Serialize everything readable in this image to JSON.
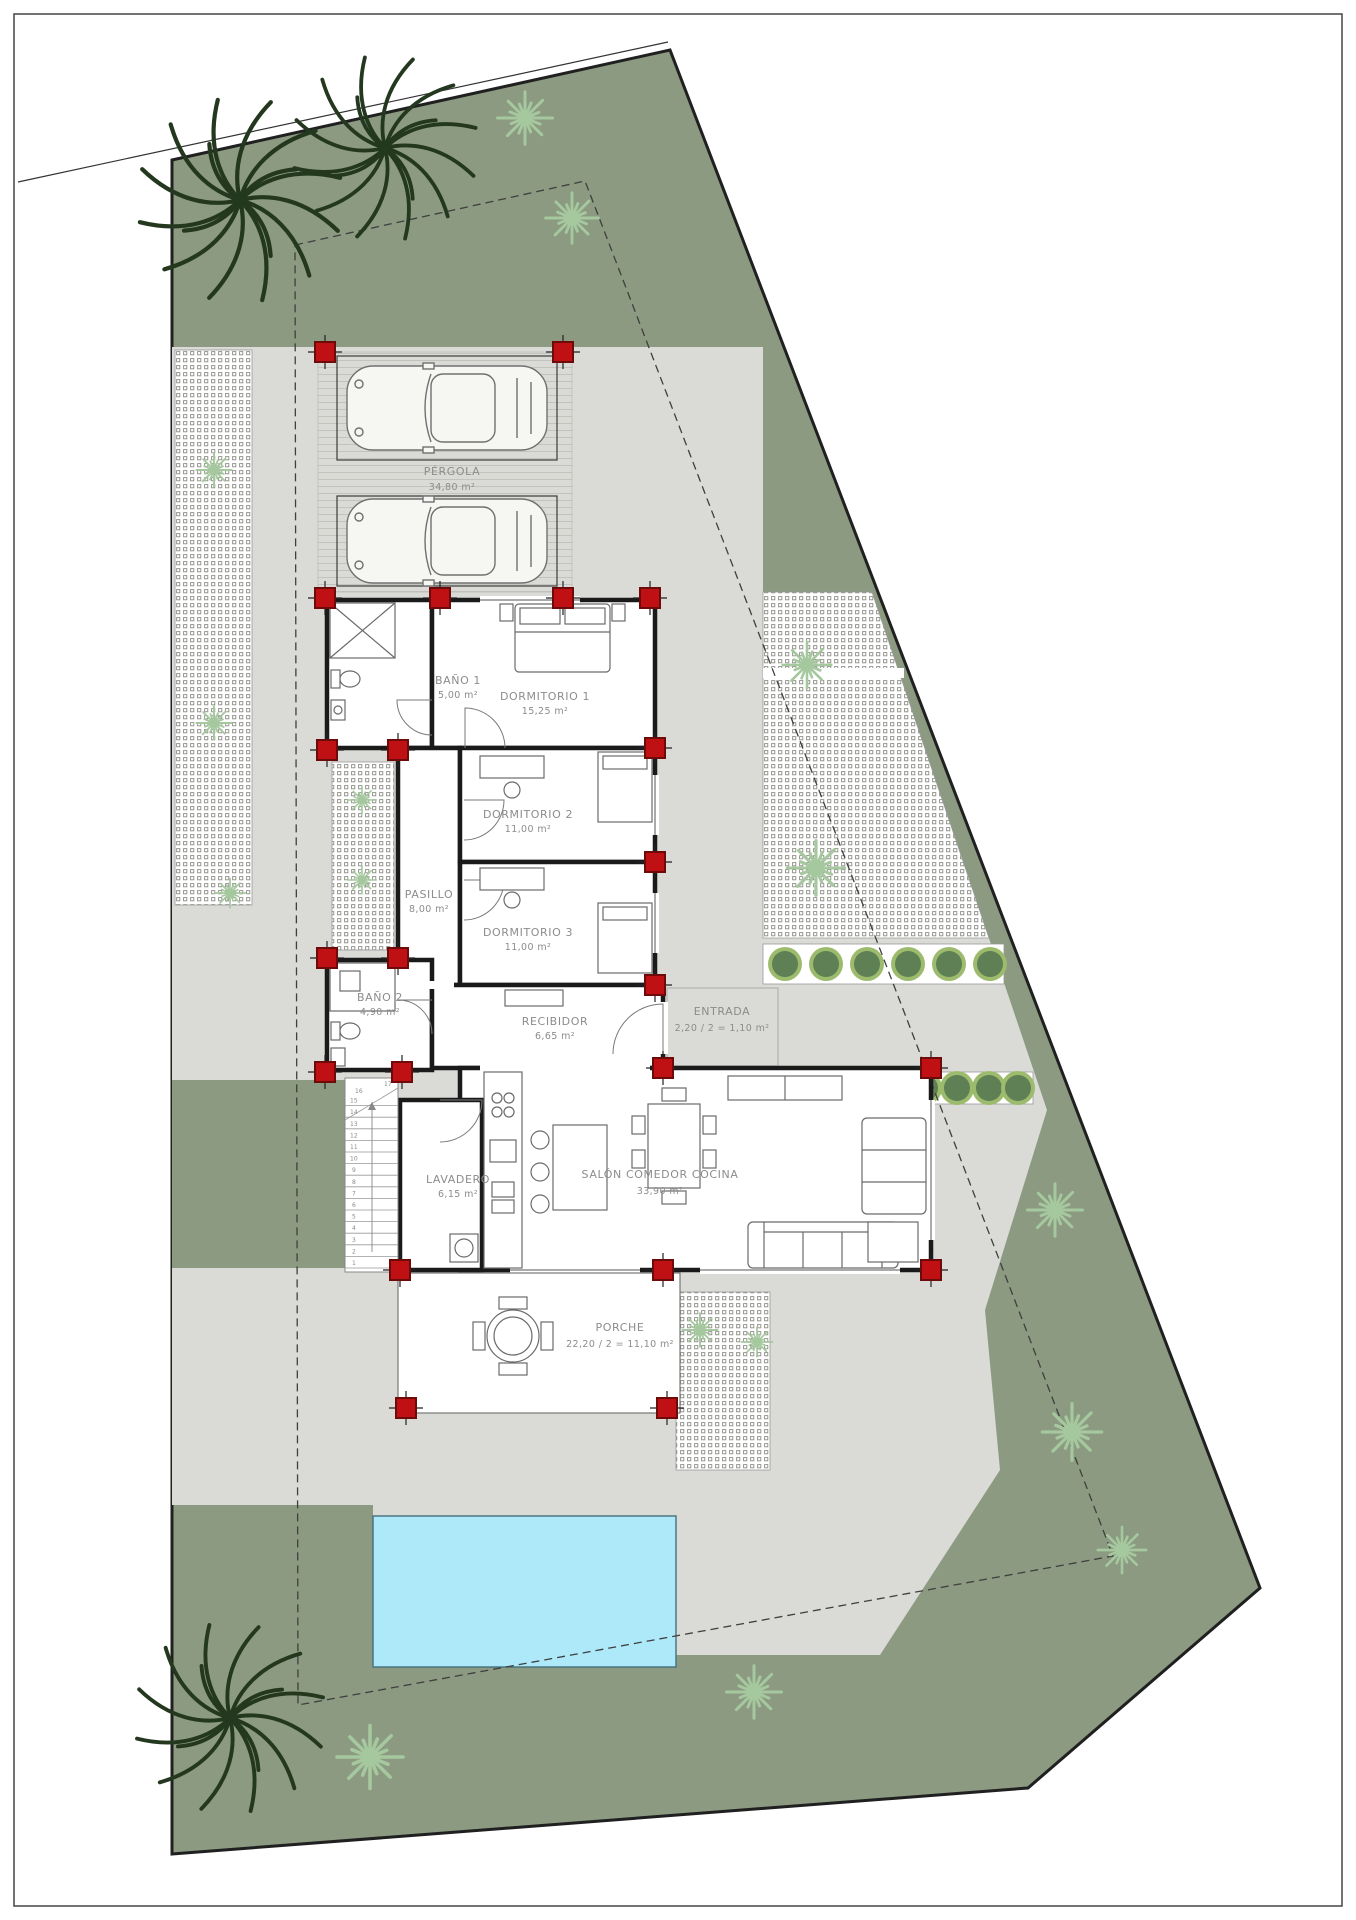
{
  "rooms": {
    "pergola": {
      "name": "PÉRGOLA",
      "area": "34,80 m²"
    },
    "dormitorio1": {
      "name": "DORMITORIO 1",
      "area": "15,25 m²"
    },
    "bano1": {
      "name": "BAÑO 1",
      "area": "5,00 m²"
    },
    "dormitorio2": {
      "name": "DORMITORIO 2",
      "area": "11,00 m²"
    },
    "pasillo": {
      "name": "PASILLO",
      "area": "8,00 m²"
    },
    "dormitorio3": {
      "name": "DORMITORIO 3",
      "area": "11,00 m²"
    },
    "bano2": {
      "name": "BAÑO 2",
      "area": "4,90 m²"
    },
    "recibidor": {
      "name": "RECIBIDOR",
      "area": "6,65 m²"
    },
    "entrada": {
      "name": "ENTRADA",
      "area": "2,20 / 2 = 1,10 m²"
    },
    "lavadero": {
      "name": "LAVADERO",
      "area": "6,15 m²"
    },
    "salon": {
      "name": "SALÓN COMEDOR COCINA",
      "area": "33,90 m²"
    },
    "porche": {
      "name": "PORCHE",
      "area": "22,20 / 2 = 11,10 m²"
    }
  },
  "stairs": {
    "numbers": [
      "1",
      "2",
      "3",
      "4",
      "5",
      "6",
      "7",
      "8",
      "9",
      "10",
      "11",
      "12",
      "13",
      "14",
      "15",
      "16",
      "17"
    ]
  },
  "colors": {
    "garden_green": "#8b9a81",
    "paving_gray": "#dadad6",
    "pool_blue": "#ade9f9",
    "pillar_red": "#bf1113",
    "wall_black": "#1a1a1a"
  }
}
